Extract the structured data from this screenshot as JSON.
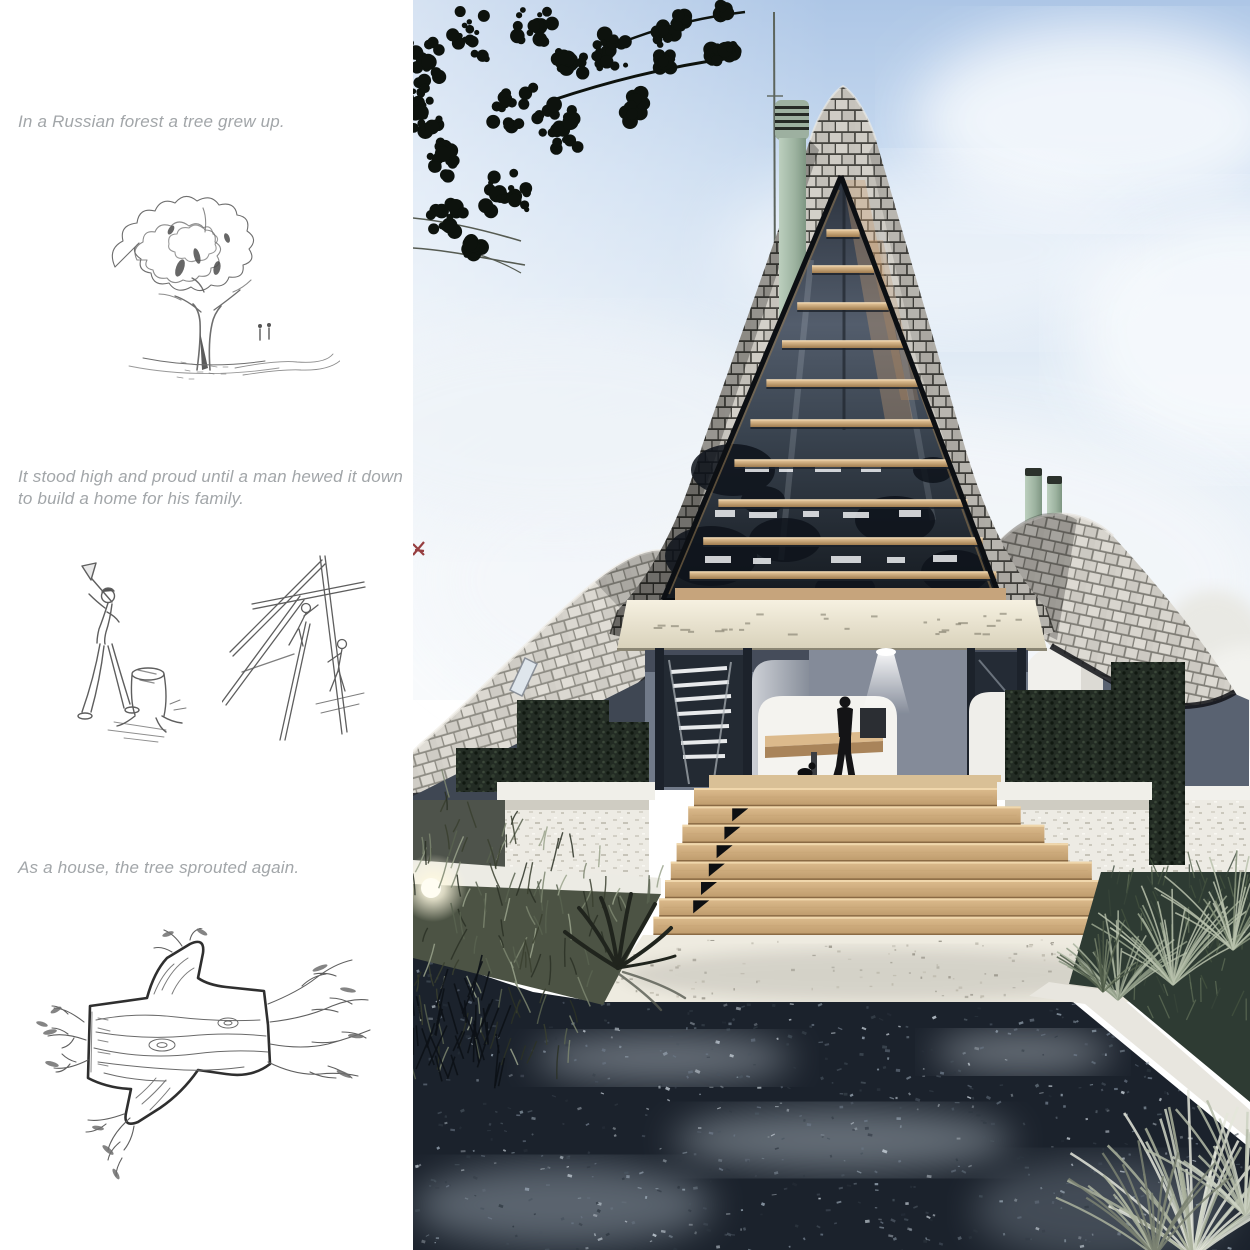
{
  "story_panel": {
    "captions": [
      "In a Russian forest a tree grew up.",
      "It stood high and proud until a man hewed it down to build a home for his family.",
      "As a house, the tree sprouted again."
    ],
    "text_color": "#a2a6a9"
  },
  "illustrations": {
    "tree_sketch": "hand-drawn tree with two small figures and a path",
    "felling_sketch": "man with axe beside a tree stump",
    "framing_sketch": "two men raising a timber frame",
    "log_sketch": "hewn log sprouting twigs and roots"
  },
  "rendering": {
    "scene": "A-frame cabin with glass gable front, shingle roof wings, wooden entry steps, woman with dog on porch, gravel path",
    "palette": {
      "sky_top": "#adc6e6",
      "sky_low": "#f2f6fa",
      "shingle_light": "#cfccc5",
      "shingle_gap": "#45443f",
      "beam_wood": "#c9a477",
      "step_wood": "#d7b587",
      "fascia": "#efe9d8",
      "wall_gray": "#717a89",
      "hedge_green": "#222b23",
      "gravel_dark": "#1b222c",
      "stone_white": "#edebe4",
      "chimney_green": "#a3b8a6",
      "red_mark": "#8d2b2c"
    }
  }
}
